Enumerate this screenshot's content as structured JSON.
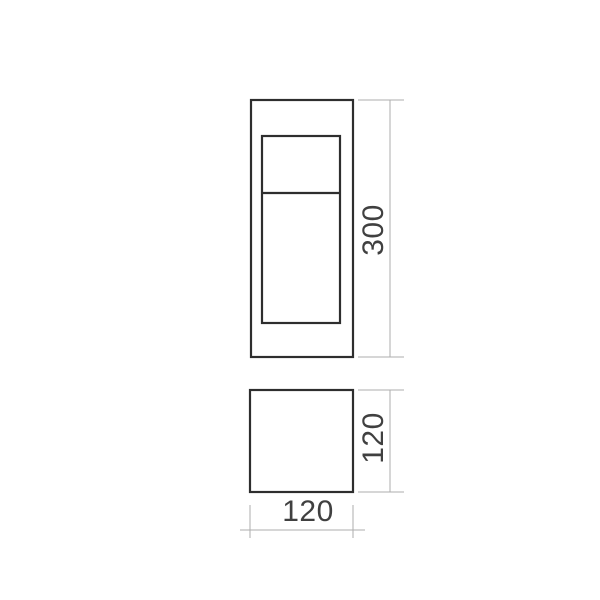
{
  "page": {
    "background": "#ffffff"
  },
  "diagram": {
    "kind": "technical-dimension-drawing",
    "units_shown": false,
    "views": [
      {
        "name": "front-view",
        "description": "rectangular luminaire body with inset panel split by a divider",
        "dimensions": [
          {
            "axis": "height",
            "value": "300"
          }
        ]
      },
      {
        "name": "bottom-view",
        "description": "square footprint",
        "dimensions": [
          {
            "axis": "height",
            "value": "120"
          },
          {
            "axis": "width",
            "value": "120"
          }
        ]
      }
    ],
    "colors": {
      "object_line": "#2e2e2e",
      "dimension_line": "#adadad",
      "label_text": "#404040",
      "background": "#ffffff"
    }
  }
}
